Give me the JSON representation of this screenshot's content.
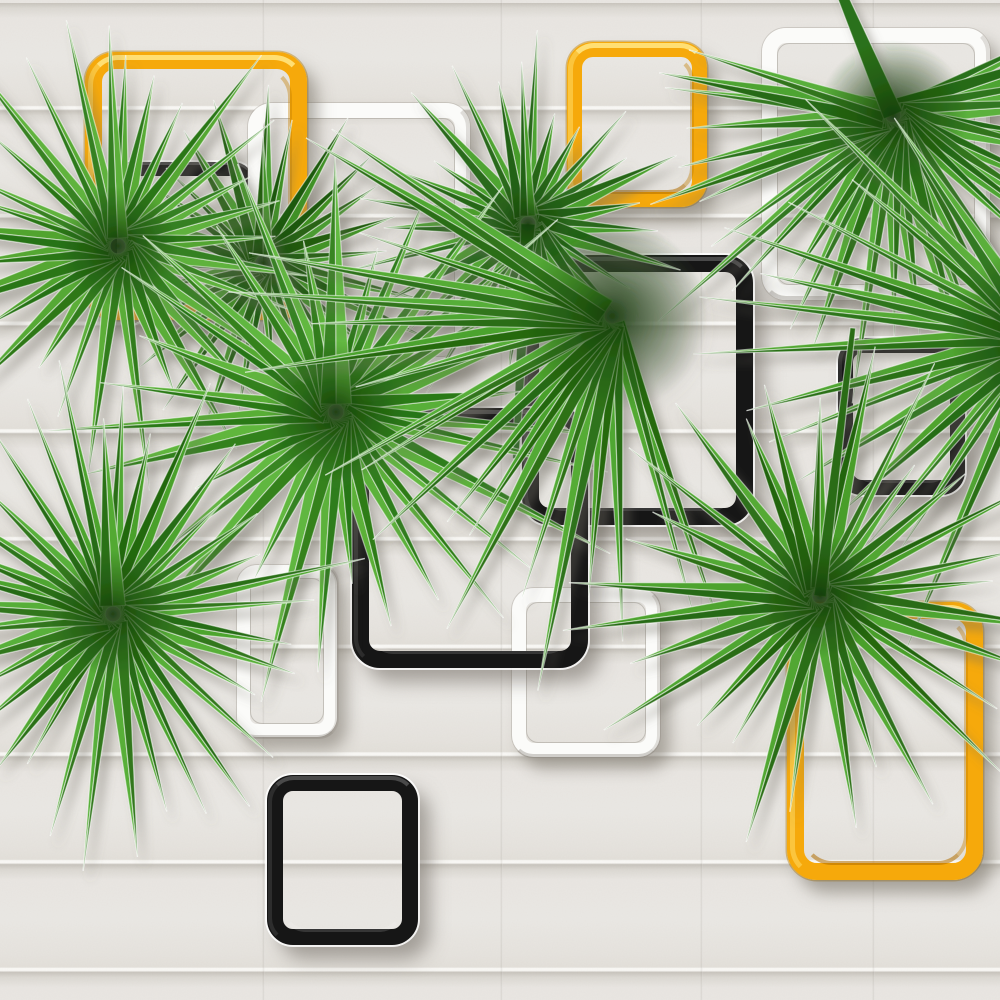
{
  "scene": {
    "canvas": {
      "width": 1000,
      "height": 1000
    },
    "wall": {
      "base_color": "#e8e5e1",
      "band_light": "#eae8e4",
      "band_mid": "#e6e3de",
      "band_lip": "#f9f8f5",
      "band_shadow": "#c9c5be",
      "band_period_px": 107.7,
      "seams_x": [
        262,
        500,
        700,
        872
      ]
    },
    "palette": {
      "yellow": "#f6a90b",
      "yellow_highlight": "#ffd95e",
      "yellow_shade": "#d98e00",
      "black": "#161616",
      "white": "#fbfbf9",
      "leaf_light": "#58ab36",
      "leaf_dark": "#2c7118",
      "leaf_center": "#173e07",
      "shadow": "#6f6a61"
    },
    "squares": [
      {
        "id": "square-black-hidden-topleft",
        "color": "black",
        "x": 103,
        "y": 162,
        "w": 152,
        "h": 150,
        "border": 14,
        "radius": 22
      },
      {
        "id": "square-white-topleft",
        "color": "white",
        "x": 248,
        "y": 103,
        "w": 222,
        "h": 269,
        "border": 15,
        "radius": 24
      },
      {
        "id": "square-yellow-topleft",
        "color": "yellow",
        "x": 85,
        "y": 52,
        "w": 222,
        "h": 268,
        "border": 17,
        "radius": 30
      },
      {
        "id": "square-yellow-topcenter",
        "color": "yellow",
        "x": 567,
        "y": 42,
        "w": 140,
        "h": 165,
        "border": 15,
        "radius": 26
      },
      {
        "id": "square-white-topright",
        "color": "white",
        "x": 762,
        "y": 28,
        "w": 228,
        "h": 272,
        "border": 15,
        "radius": 24
      },
      {
        "id": "square-black-center",
        "color": "black",
        "x": 522,
        "y": 255,
        "w": 231,
        "h": 270,
        "border": 17,
        "radius": 28
      },
      {
        "id": "square-white-bottomcenter",
        "color": "white",
        "x": 512,
        "y": 588,
        "w": 148,
        "h": 169,
        "border": 14,
        "radius": 22
      },
      {
        "id": "square-black-centerleft",
        "color": "black",
        "x": 352,
        "y": 408,
        "w": 236,
        "h": 260,
        "border": 17,
        "radius": 28
      },
      {
        "id": "square-white-left",
        "color": "white",
        "x": 237,
        "y": 565,
        "w": 100,
        "h": 172,
        "border": 13,
        "radius": 20
      },
      {
        "id": "square-black-right",
        "color": "black",
        "x": 838,
        "y": 338,
        "w": 127,
        "h": 157,
        "border": 15,
        "radius": 24
      },
      {
        "id": "square-yellow-bottomright",
        "color": "yellow",
        "x": 787,
        "y": 602,
        "w": 196,
        "h": 278,
        "border": 17,
        "radius": 30
      },
      {
        "id": "square-black-bottom",
        "color": "black",
        "x": 267,
        "y": 775,
        "w": 151,
        "h": 170,
        "border": 16,
        "radius": 26
      }
    ],
    "leaves": [
      {
        "id": "palm-fan-upper-left-dark",
        "cx": 263,
        "cy": 263,
        "blades": 26,
        "a0": -90,
        "a1": 270,
        "r": 152,
        "rv": 40,
        "w": 10,
        "light": "#46962b",
        "dark": "#245f12"
      },
      {
        "id": "palm-fan-upper-left",
        "cx": 118,
        "cy": 246,
        "blades": 30,
        "a0": -90,
        "a1": 270,
        "r": 200,
        "rv": 55,
        "w": 11,
        "light": "#58ab36",
        "dark": "#2f7a1b"
      },
      {
        "id": "palm-fan-top-center",
        "cx": 528,
        "cy": 224,
        "blades": 28,
        "a0": -90,
        "a1": 270,
        "r": 152,
        "rv": 48,
        "w": 10,
        "light": "#4da22f",
        "dark": "#28681a",
        "stem": {
          "a": 93,
          "len": 235,
          "w": 7
        }
      },
      {
        "id": "palm-fan-top-right",
        "cx": 893,
        "cy": 115,
        "blades": 30,
        "a0": -25,
        "a1": 200,
        "r": 250,
        "rv": 65,
        "w": 12,
        "light": "#55ab37",
        "dark": "#2c711a",
        "stem": {
          "a": -113,
          "len": 150,
          "w": 10
        }
      },
      {
        "id": "palm-fan-right-edge",
        "cx": 1040,
        "cy": 335,
        "blades": 15,
        "a0": 115,
        "a1": 235,
        "r": 300,
        "rv": 60,
        "w": 11,
        "light": "#54a934",
        "dark": "#2d731b"
      },
      {
        "id": "palm-fan-left-large",
        "cx": 336,
        "cy": 412,
        "blades": 32,
        "a0": -90,
        "a1": 270,
        "r": 235,
        "rv": 75,
        "w": 12,
        "light": "#5cb23a",
        "dark": "#2f7d1a"
      },
      {
        "id": "palm-fan-center-droop",
        "cx": 612,
        "cy": 316,
        "blades": 20,
        "a0": 70,
        "a1": 215,
        "r": 320,
        "rv": 85,
        "w": 11,
        "light": "#51a832",
        "dark": "#2b6f16"
      },
      {
        "id": "palm-fan-lower-right",
        "cx": 820,
        "cy": 596,
        "blades": 30,
        "a0": -90,
        "a1": 270,
        "r": 205,
        "rv": 55,
        "w": 11,
        "light": "#4fa530",
        "dark": "#2a6c15",
        "stem": {
          "a": -83,
          "len": 270,
          "w": 6
        }
      },
      {
        "id": "palm-fan-lower-left",
        "cx": 113,
        "cy": 614,
        "blades": 34,
        "a0": -90,
        "a1": 270,
        "r": 212,
        "rv": 60,
        "w": 11,
        "light": "#52a933",
        "dark": "#2c7118"
      }
    ]
  }
}
